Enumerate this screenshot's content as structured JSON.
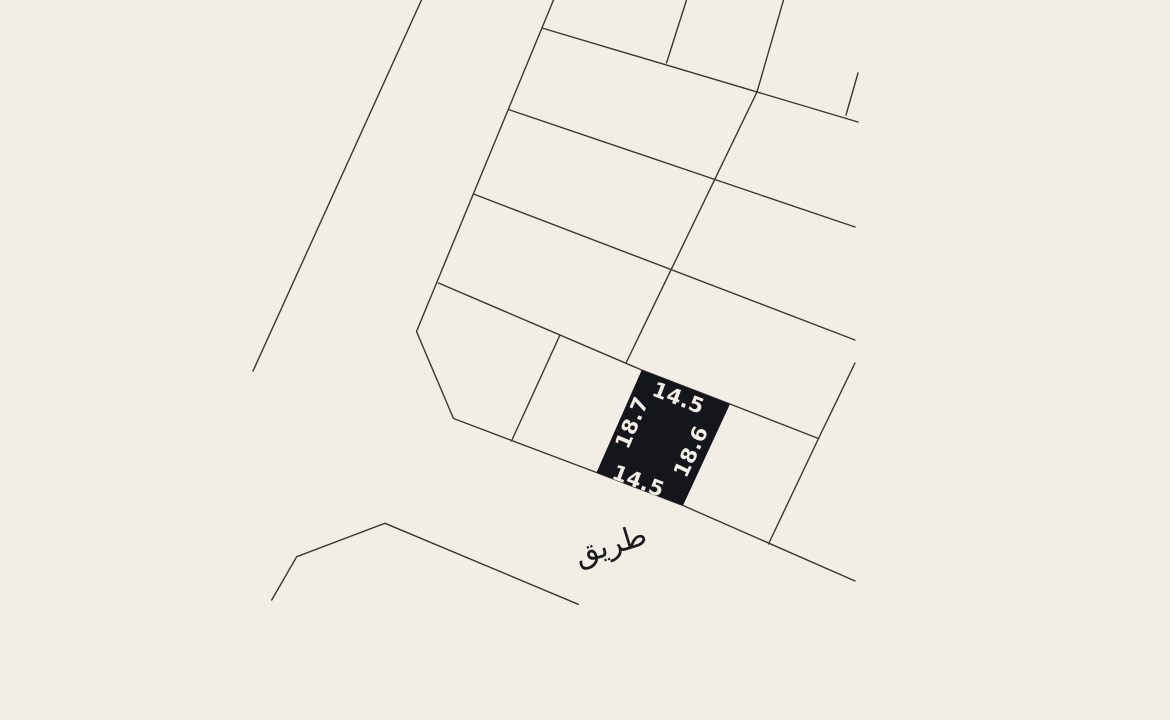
{
  "canvas": {
    "width": 1170,
    "height": 720,
    "background_color": "#f3eee5"
  },
  "map": {
    "stroke_color": "#3a3731",
    "stroke_width": 1.4,
    "boundary_lines": [
      {
        "name": "west-road-line",
        "points": [
          [
            421.5,
            0
          ],
          [
            253,
            371
          ]
        ]
      },
      {
        "name": "block-west-and-south-boundary",
        "points": [
          [
            553.5,
            0
          ],
          [
            416.5,
            331.5
          ],
          [
            453.5,
            418.5
          ],
          [
            596.5,
            472.5
          ],
          [
            683,
            505.5
          ],
          [
            855,
            581
          ]
        ]
      },
      {
        "name": "row-divider-1",
        "points": [
          [
            542,
            28
          ],
          [
            858,
            122
          ]
        ]
      },
      {
        "name": "column-stub-north",
        "points": [
          [
            686.5,
            0
          ],
          [
            666.5,
            63
          ]
        ]
      },
      {
        "name": "column-spine",
        "points": [
          [
            783.5,
            0
          ],
          [
            757,
            92
          ],
          [
            626,
            363
          ]
        ]
      },
      {
        "name": "row-divider-2",
        "points": [
          [
            508.5,
            109.5
          ],
          [
            855,
            227
          ]
        ]
      },
      {
        "name": "row-divider-3",
        "points": [
          [
            473.5,
            194
          ],
          [
            855,
            340
          ]
        ]
      },
      {
        "name": "row-divider-4",
        "points": [
          [
            438.5,
            283
          ],
          [
            641.7,
            370
          ],
          [
            730,
            404
          ],
          [
            818.5,
            438.5
          ]
        ]
      },
      {
        "name": "east-edge-stub",
        "points": [
          [
            858,
            73
          ],
          [
            846,
            115
          ]
        ]
      },
      {
        "name": "column-divider-west",
        "points": [
          [
            560,
            335
          ],
          [
            511.5,
            441
          ]
        ]
      },
      {
        "name": "column-divider-east",
        "points": [
          [
            855,
            363
          ],
          [
            818.5,
            438.5
          ],
          [
            768.5,
            544
          ]
        ]
      },
      {
        "name": "south-road-line",
        "points": [
          [
            271.7,
            600
          ],
          [
            296.7,
            556.7
          ],
          [
            385,
            523.3
          ],
          [
            578.3,
            604.3
          ]
        ]
      }
    ],
    "highlighted_parcel": {
      "fill_color": "#15151c",
      "points": [
        [
          641.7,
          370
        ],
        [
          730,
          404
        ],
        [
          683,
          505.5
        ],
        [
          596.5,
          472.5
        ]
      ],
      "label_color": "#f3eee5",
      "label_font_size": 21,
      "dimension_labels": [
        {
          "side": "north",
          "text": "14.5",
          "x": 678,
          "y": 399,
          "rotation": 21
        },
        {
          "side": "west",
          "text": "18.7",
          "x": 633,
          "y": 423,
          "rotation": -67
        },
        {
          "side": "east",
          "text": "18.6",
          "x": 692,
          "y": 452,
          "rotation": -65
        },
        {
          "side": "south",
          "text": "14.5",
          "x": 638,
          "y": 482,
          "rotation": 21
        }
      ]
    },
    "road_label": {
      "text": "طريق",
      "x": 611,
      "y": 546,
      "rotation": -17,
      "color": "#1a1a21",
      "font_size": 30
    }
  }
}
